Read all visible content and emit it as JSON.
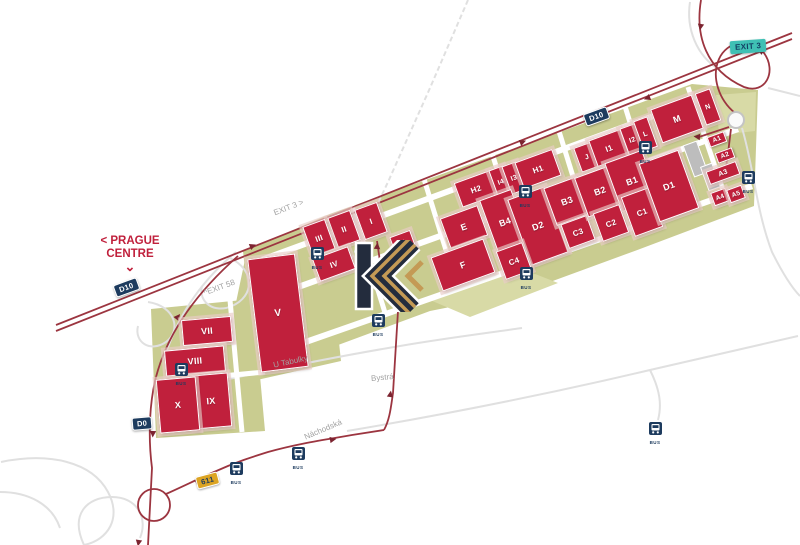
{
  "map": {
    "colors": {
      "building": "#c0203c",
      "park": "#c9cc90",
      "park_light": "#d8daa6",
      "highway": "#9c3540",
      "arrow": "#7c2430",
      "shield_navy": "#1d3b5e",
      "shield_yellow": "#dca423",
      "exit_badge": "#3fc0b4",
      "minor_road": "#dedede",
      "logo_navy": "#232c3d",
      "logo_gold": "#c49a55"
    },
    "direction_sign": {
      "line1": "< PRAGUE",
      "line2": "CENTRE",
      "arrow": "⌄"
    },
    "exit_badge": {
      "label": "EXIT 3"
    },
    "bus_label": "BUS",
    "buildings": [
      {
        "id": "i",
        "label": "I",
        "x": 370,
        "y": 220,
        "w": 22,
        "h": 30,
        "r": -20,
        "fs": 8
      },
      {
        "id": "ii",
        "label": "II",
        "x": 343,
        "y": 228,
        "w": 22,
        "h": 30,
        "r": -20,
        "fs": 8
      },
      {
        "id": "iii",
        "label": "III",
        "x": 318,
        "y": 237,
        "w": 22,
        "h": 30,
        "r": -20,
        "fs": 8
      },
      {
        "id": "iv",
        "label": "IV",
        "x": 333,
        "y": 263,
        "w": 36,
        "h": 22,
        "r": -20,
        "fs": 8
      },
      {
        "id": "v",
        "label": "V",
        "x": 277,
        "y": 312,
        "w": 46,
        "h": 112,
        "r": -7,
        "fs": 10
      },
      {
        "id": "vii",
        "label": "VII",
        "x": 206,
        "y": 330,
        "w": 48,
        "h": 24,
        "r": -5,
        "fs": 9
      },
      {
        "id": "viii",
        "label": "VIII",
        "x": 194,
        "y": 360,
        "w": 58,
        "h": 24,
        "r": -5,
        "fs": 9
      },
      {
        "id": "ix",
        "label": "IX",
        "x": 210,
        "y": 400,
        "w": 36,
        "h": 52,
        "r": -5,
        "fs": 9
      },
      {
        "id": "x",
        "label": "X",
        "x": 177,
        "y": 404,
        "w": 38,
        "h": 52,
        "r": -5,
        "fs": 9
      },
      {
        "id": "k",
        "label": "K",
        "x": 402,
        "y": 242,
        "w": 20,
        "h": 18,
        "r": -20,
        "fs": 7
      },
      {
        "id": "h2",
        "label": "H2",
        "x": 475,
        "y": 188,
        "w": 36,
        "h": 24,
        "r": -20,
        "fs": 8
      },
      {
        "id": "i4",
        "label": "I4",
        "x": 500,
        "y": 181,
        "w": 14,
        "h": 28,
        "r": -20,
        "fs": 7
      },
      {
        "id": "i3",
        "label": "I3",
        "x": 513,
        "y": 177,
        "w": 14,
        "h": 28,
        "r": -20,
        "fs": 7
      },
      {
        "id": "h1",
        "label": "H1",
        "x": 537,
        "y": 168,
        "w": 38,
        "h": 26,
        "r": -20,
        "fs": 8
      },
      {
        "id": "e",
        "label": "E",
        "x": 463,
        "y": 226,
        "w": 38,
        "h": 30,
        "r": -20,
        "fs": 9
      },
      {
        "id": "b4",
        "label": "B4",
        "x": 504,
        "y": 221,
        "w": 32,
        "h": 56,
        "r": -20,
        "fs": 9
      },
      {
        "id": "d2",
        "label": "D2",
        "x": 537,
        "y": 225,
        "w": 38,
        "h": 68,
        "r": -20,
        "fs": 9
      },
      {
        "id": "c4",
        "label": "C4",
        "x": 513,
        "y": 260,
        "w": 26,
        "h": 28,
        "r": -20,
        "fs": 8
      },
      {
        "id": "f",
        "label": "F",
        "x": 462,
        "y": 264,
        "w": 54,
        "h": 34,
        "r": -20,
        "fs": 9
      },
      {
        "id": "b3",
        "label": "B3",
        "x": 566,
        "y": 200,
        "w": 34,
        "h": 38,
        "r": -20,
        "fs": 9
      },
      {
        "id": "c3",
        "label": "C3",
        "x": 577,
        "y": 231,
        "w": 26,
        "h": 24,
        "r": -20,
        "fs": 8
      },
      {
        "id": "j",
        "label": "J",
        "x": 586,
        "y": 156,
        "w": 18,
        "h": 24,
        "r": -20,
        "fs": 7
      },
      {
        "id": "i1",
        "label": "I1",
        "x": 608,
        "y": 147,
        "w": 32,
        "h": 26,
        "r": -20,
        "fs": 8
      },
      {
        "id": "i2",
        "label": "I2",
        "x": 631,
        "y": 139,
        "w": 15,
        "h": 28,
        "r": -20,
        "fs": 7
      },
      {
        "id": "l",
        "label": "L",
        "x": 644,
        "y": 133,
        "w": 13,
        "h": 30,
        "r": -20,
        "fs": 7
      },
      {
        "id": "b2",
        "label": "B2",
        "x": 599,
        "y": 190,
        "w": 38,
        "h": 40,
        "r": -20,
        "fs": 9
      },
      {
        "id": "b1",
        "label": "B1",
        "x": 631,
        "y": 180,
        "w": 38,
        "h": 50,
        "r": -20,
        "fs": 9
      },
      {
        "id": "c2",
        "label": "C2",
        "x": 610,
        "y": 222,
        "w": 26,
        "h": 28,
        "r": -20,
        "fs": 8
      },
      {
        "id": "c1",
        "label": "C1",
        "x": 641,
        "y": 211,
        "w": 28,
        "h": 40,
        "r": -20,
        "fs": 8
      },
      {
        "id": "d1",
        "label": "D1",
        "x": 668,
        "y": 185,
        "w": 40,
        "h": 60,
        "r": -20,
        "fs": 9
      },
      {
        "id": "m",
        "label": "M",
        "x": 676,
        "y": 118,
        "w": 42,
        "h": 34,
        "r": -20,
        "fs": 9
      },
      {
        "id": "n",
        "label": "N",
        "x": 707,
        "y": 106,
        "w": 14,
        "h": 32,
        "r": -20,
        "fs": 7
      },
      {
        "id": "a1",
        "label": "A1",
        "x": 716,
        "y": 138,
        "w": 16,
        "h": 9,
        "r": -20,
        "fs": 6.5,
        "chip": true
      },
      {
        "id": "a2",
        "label": "A2",
        "x": 724,
        "y": 154,
        "w": 16,
        "h": 9,
        "r": -20,
        "fs": 6.5,
        "chip": true
      },
      {
        "id": "a3",
        "label": "A3",
        "x": 722,
        "y": 172,
        "w": 30,
        "h": 12,
        "r": -20,
        "fs": 7
      },
      {
        "id": "a4",
        "label": "A4",
        "x": 719,
        "y": 196,
        "w": 14,
        "h": 12,
        "r": -20,
        "fs": 6.5
      },
      {
        "id": "a5",
        "label": "A5",
        "x": 735,
        "y": 193,
        "w": 14,
        "h": 12,
        "r": -20,
        "fs": 6.5
      }
    ],
    "gray_buildings": [
      {
        "x": 287,
        "y": 317,
        "w": 16,
        "h": 14,
        "r": -5
      },
      {
        "x": 694,
        "y": 158,
        "w": 13,
        "h": 32,
        "r": -20
      },
      {
        "x": 709,
        "y": 176,
        "w": 11,
        "h": 24,
        "r": -20
      }
    ],
    "bus_stops": [
      {
        "x": 317,
        "y": 253
      },
      {
        "x": 525,
        "y": 191
      },
      {
        "x": 526,
        "y": 273
      },
      {
        "x": 645,
        "y": 147
      },
      {
        "x": 748,
        "y": 177
      },
      {
        "x": 181,
        "y": 369
      },
      {
        "x": 378,
        "y": 320
      },
      {
        "x": 236,
        "y": 468
      },
      {
        "x": 298,
        "y": 453
      },
      {
        "x": 655,
        "y": 428
      }
    ],
    "shields": [
      {
        "label": "D10",
        "x": 597,
        "y": 117,
        "r": -20,
        "type": "navy"
      },
      {
        "label": "D10",
        "x": 127,
        "y": 288,
        "r": -20,
        "type": "navy"
      },
      {
        "label": "D0",
        "x": 145,
        "y": 424,
        "r": -5,
        "type": "navy"
      },
      {
        "label": "611",
        "x": 209,
        "y": 481,
        "r": -15,
        "type": "yellow"
      }
    ],
    "road_labels": [
      {
        "text": "EXIT 3 >",
        "x": 303,
        "y": 209,
        "r": -21
      },
      {
        "text": "^EXIT 58",
        "x": 233,
        "y": 289,
        "r": -20
      },
      {
        "text": "U Tabulky",
        "x": 303,
        "y": 363,
        "r": -12
      },
      {
        "text": "Bystrá",
        "x": 401,
        "y": 379,
        "r": -5
      },
      {
        "text": "Náchodská",
        "x": 333,
        "y": 431,
        "r": -23
      }
    ],
    "logo": {
      "letter": "K"
    }
  }
}
